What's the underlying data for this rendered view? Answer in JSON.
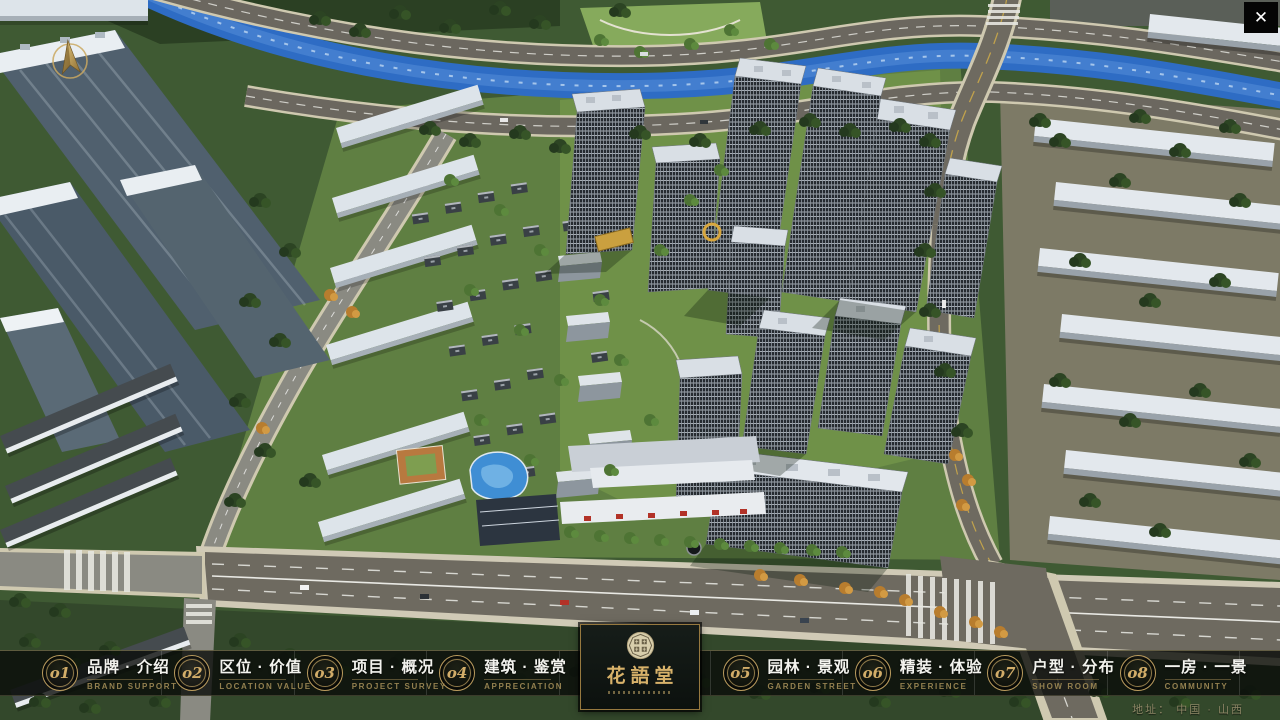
{
  "window": {
    "close_glyph": "✕"
  },
  "nav": {
    "items": [
      {
        "num": "o1",
        "title": "品牌 · 介绍",
        "subtitle": "BRAND SUPPORT"
      },
      {
        "num": "o2",
        "title": "区位 · 价值",
        "subtitle": "LOCATION VALUE"
      },
      {
        "num": "o3",
        "title": "项目 · 概况",
        "subtitle": "PROJECT SURVEY"
      },
      {
        "num": "o4",
        "title": "建筑 · 鉴赏",
        "subtitle": "APPRECIATION"
      },
      {
        "num": "o5",
        "title": "园林 · 景观",
        "subtitle": "GARDEN STREET"
      },
      {
        "num": "o6",
        "title": "精装 · 体验",
        "subtitle": "EXPERIENCE"
      },
      {
        "num": "o7",
        "title": "户型 · 分布",
        "subtitle": "SHOW ROOM"
      },
      {
        "num": "o8",
        "title": "一房 · 一景",
        "subtitle": "COMMUNITY"
      }
    ]
  },
  "logo": {
    "title": "花語堂"
  },
  "footer": {
    "address": "地址： 中国 · 山西"
  },
  "colors": {
    "gold": "#c8a565",
    "nav_bg": "rgba(9,11,9,0.8)",
    "title_text": "#f3f3ee",
    "subtitle_text": "#93804f"
  }
}
